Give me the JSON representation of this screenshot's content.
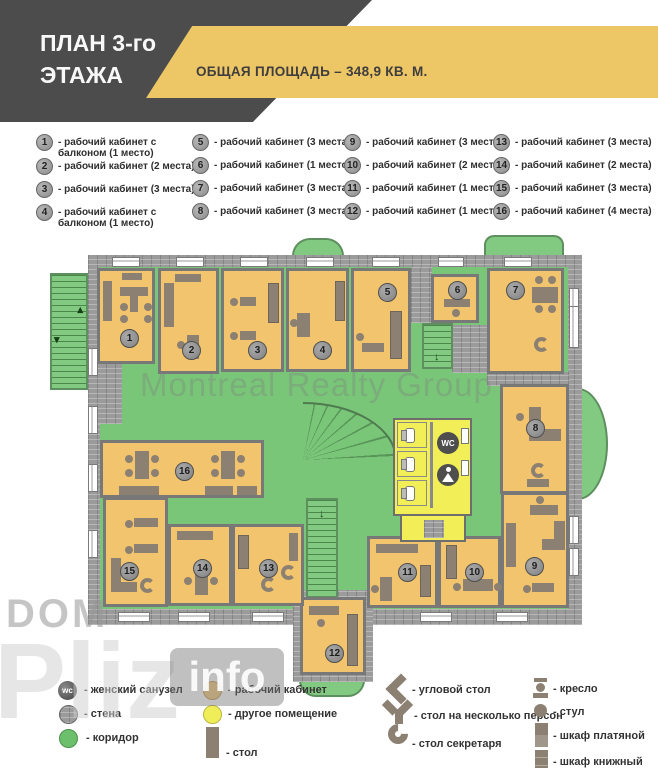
{
  "header": {
    "title_line1": "ПЛАН 3-го",
    "title_line2": "ЭТАЖА",
    "area_banner": "ОБЩАЯ ПЛОЩАДЬ – 348,9 КВ. М."
  },
  "legend_top": {
    "items": [
      {
        "num": "1",
        "label": "- рабочий кабинет с балконом (1 место)"
      },
      {
        "num": "2",
        "label": "- рабочий кабинет (2 места)"
      },
      {
        "num": "3",
        "label": "- рабочий кабинет (3 места)"
      },
      {
        "num": "4",
        "label": "- рабочий кабинет с балконом (1 место)"
      },
      {
        "num": "5",
        "label": "- рабочий кабинет (3 места)"
      },
      {
        "num": "6",
        "label": "- рабочий кабинет (1 место)"
      },
      {
        "num": "7",
        "label": "- рабочий кабинет (3 места)"
      },
      {
        "num": "8",
        "label": "- рабочий кабинет (3 места)"
      },
      {
        "num": "9",
        "label": "- рабочий кабинет (3 места)"
      },
      {
        "num": "10",
        "label": "- рабочий кабинет (2 места)"
      },
      {
        "num": "11",
        "label": "- рабочий кабинет (1 место)"
      },
      {
        "num": "12",
        "label": "- рабочий кабинет (1 место)"
      },
      {
        "num": "13",
        "label": "- рабочий кабинет (3 места)"
      },
      {
        "num": "14",
        "label": "- рабочий кабинет (2 места)"
      },
      {
        "num": "15",
        "label": "- рабочий кабинет (3 места)"
      },
      {
        "num": "16",
        "label": "- рабочий кабинет (4 места)"
      }
    ]
  },
  "plan": {
    "wc_label": "WC",
    "rooms": [
      {
        "num": "1"
      },
      {
        "num": "2"
      },
      {
        "num": "3"
      },
      {
        "num": "4"
      },
      {
        "num": "5"
      },
      {
        "num": "6"
      },
      {
        "num": "7"
      },
      {
        "num": "8"
      },
      {
        "num": "9"
      },
      {
        "num": "10"
      },
      {
        "num": "11"
      },
      {
        "num": "12"
      },
      {
        "num": "13"
      },
      {
        "num": "14"
      },
      {
        "num": "15"
      },
      {
        "num": "16"
      }
    ],
    "watermarks": {
      "main": "Montreal Realty Group",
      "dom": "DOM",
      "pliz": "Pliz",
      "info": "info"
    }
  },
  "legend_bottom": {
    "items": [
      {
        "icon": "wc-icon",
        "label": "- женский санузел"
      },
      {
        "icon": "wall-icon",
        "label": "- стена"
      },
      {
        "icon": "corridor-icon",
        "label": "- коридор"
      },
      {
        "icon": "office-icon",
        "label": "- рабочий кабинет"
      },
      {
        "icon": "other-room-icon",
        "label": "- другое помещение"
      },
      {
        "icon": "desk-icon",
        "label": "- стол"
      },
      {
        "icon": "corner-desk-icon",
        "label": "- угловой стол"
      },
      {
        "icon": "multi-desk-icon",
        "label": "- стол на несколько персон"
      },
      {
        "icon": "secretary-desk-icon",
        "label": "- стол секретаря"
      },
      {
        "icon": "armchair-icon",
        "label": "- кресло"
      },
      {
        "icon": "chair-icon",
        "label": "- стул"
      },
      {
        "icon": "wardrobe-icon",
        "label": "- шкаф платяной"
      },
      {
        "icon": "bookcase-icon",
        "label": "- шкаф книжный"
      }
    ]
  },
  "colors": {
    "header_dark": "#4c4c4c",
    "accent_gold": "#edc666",
    "room_orange": "#f2c46e",
    "corridor_green": "#79c679",
    "other_room_yellow": "#f1ee58",
    "wall_gray": "#9b9b9b",
    "furniture_brown": "#8b8071"
  }
}
